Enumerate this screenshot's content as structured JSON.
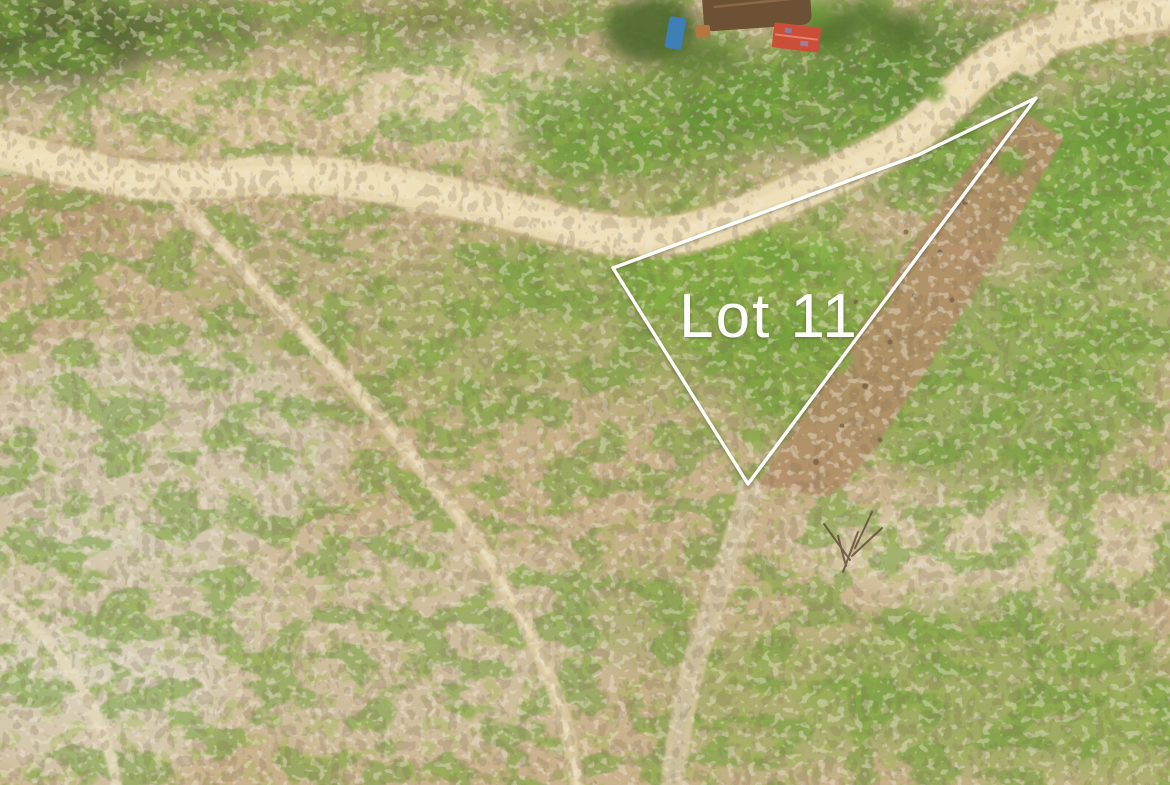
{
  "photo": {
    "overlay": {
      "lot_label": "Lot 11",
      "polygon_points": "613,268 918,155 1036,98 748,484",
      "line_color": "#ffffff",
      "label_color": "#ffffff"
    },
    "colors": {
      "dry_ground": "#c9b28c",
      "road": "#e8d8b0",
      "road_center": "#f1e3bd",
      "road_edge": "#c9b183",
      "green_shrub": "#6f9c38",
      "dead_grass": "#efe9d6",
      "twigs": "#7a6a50",
      "gully_brown": "#b3906a",
      "thatch_roof": "#6d5134",
      "red_roof": "#cb4f38",
      "blue_object": "#3f7fb7",
      "hut_tan": "#b5773f"
    }
  }
}
